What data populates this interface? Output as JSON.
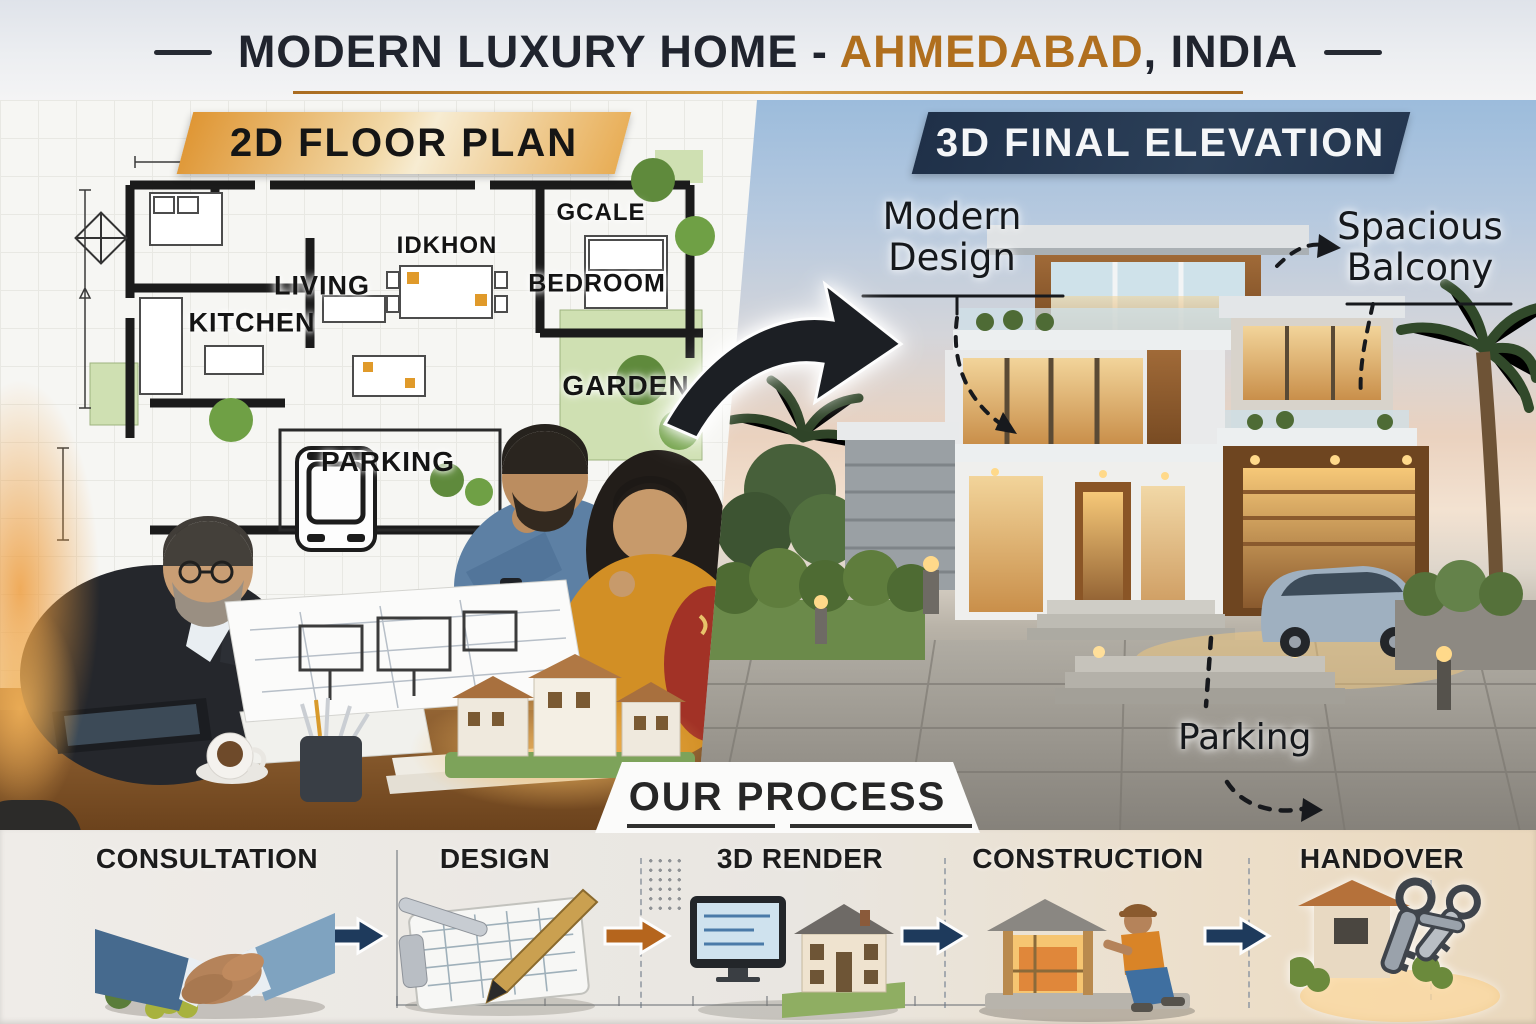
{
  "header": {
    "title_prefix": "MODERN LUXURY HOME - ",
    "title_city": "AHMEDABAD",
    "title_suffix": ", INDIA"
  },
  "left_panel": {
    "banner_label": "2D FLOOR PLAN",
    "room_labels": {
      "kitchen": "KITCHEN",
      "living": "LIVING",
      "dining": "IDKHON",
      "closet": "GCALE",
      "bedroom": "BEDROOM",
      "garden": "GARDEN",
      "parking": "PARKING"
    }
  },
  "right_panel": {
    "banner_label": "3D FINAL ELEVATION",
    "annotations": {
      "modern_design": "Modern Design",
      "spacious_balcony": "Spacious Balcony",
      "parking": "Parking"
    }
  },
  "process": {
    "title": "OUR PROCESS",
    "steps": [
      {
        "label": "CONSULTATION",
        "icon": "handshake-icon"
      },
      {
        "label": "DESIGN",
        "icon": "clipboard-pen-icon"
      },
      {
        "label": "3D RENDER",
        "icon": "monitor-house-icon"
      },
      {
        "label": "CONSTRUCTION",
        "icon": "builder-icon"
      },
      {
        "label": "HANDOVER",
        "icon": "house-keys-icon"
      }
    ]
  },
  "colors": {
    "accent_gold": "#b06f1e",
    "banner_gold": "#e9a94e",
    "banner_navy": "#24364f",
    "arrow_navy": "#1e3a5c",
    "arrow_orange": "#b5651d",
    "title_dark": "#20242e"
  }
}
